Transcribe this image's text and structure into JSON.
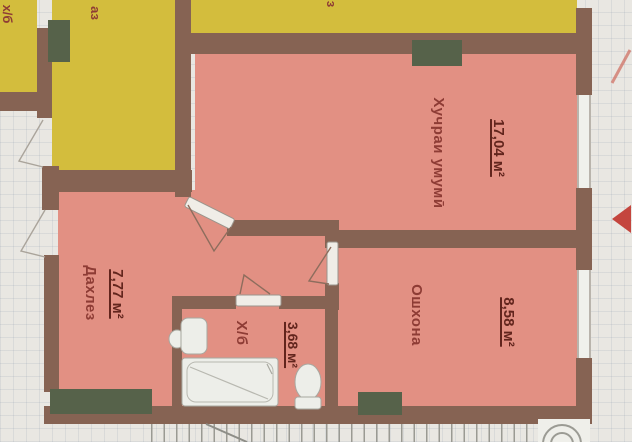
{
  "plan_title": "apartment-floor-plan",
  "rooms": {
    "living": {
      "label": "Хучраи умумӣ",
      "area": "17,04 м²"
    },
    "kitchen": {
      "label": "Ошхона",
      "area": "8,58 м²"
    },
    "hall": {
      "label": "Дахлез",
      "area": "7,77 м²"
    },
    "bath": {
      "label": "Х/б",
      "area": "3,68 м²"
    }
  },
  "fragments": {
    "top_left_a": "х/б",
    "top_left_b": "аз",
    "top_mid": "з"
  },
  "colors": {
    "salmon": "#e29083",
    "yellow": "#d3bd3d",
    "wall": "#866353",
    "green": "#56624a",
    "label": "#8e3c35",
    "value": "#62251d",
    "paper": "#e9e7e2",
    "fixture": "#edeee9",
    "mark_red": "#c4453e"
  }
}
